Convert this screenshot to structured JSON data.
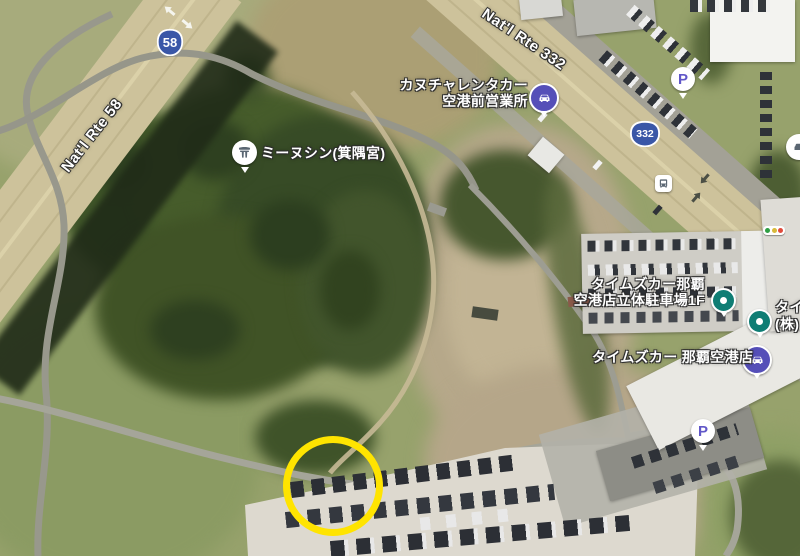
{
  "map_type": "satellite",
  "road_labels": {
    "rte58": "Nat'l Rte 58",
    "rte332": "Nat'l Rte 332"
  },
  "route_shields": {
    "shield1": "58",
    "shield2": "332"
  },
  "places": {
    "rental_office": {
      "line1": "カヌチャレンタカー",
      "line2": "空港前営業所"
    },
    "shrine": {
      "name": "ミーヌシン(箕隅宮)"
    },
    "times_parking_deck": {
      "line1": "タイムズカー那覇",
      "line2": "空港店立体駐車場1F"
    },
    "times_airport_shop": {
      "name": "タイムズカー 那覇空港店"
    },
    "edge_clipped": {
      "line1": "タイム",
      "line2": "(株)"
    }
  },
  "icons": {
    "parking_label": "P"
  },
  "annotation": {
    "type": "circle-highlight",
    "color": "#FFE400"
  },
  "colors": {
    "grass": "#97a26c",
    "forest": "#3e5228",
    "dirt": "#b8aa8a",
    "highway_tan": "#cfc49c",
    "road_gray": "#9a9a90",
    "shield_blue": "#3a57a7",
    "icon_indigo": "#554fb8",
    "poi_teal": "#0f7d74",
    "parking_purple": "#6157c8",
    "annotation_yellow": "#FFE400"
  }
}
